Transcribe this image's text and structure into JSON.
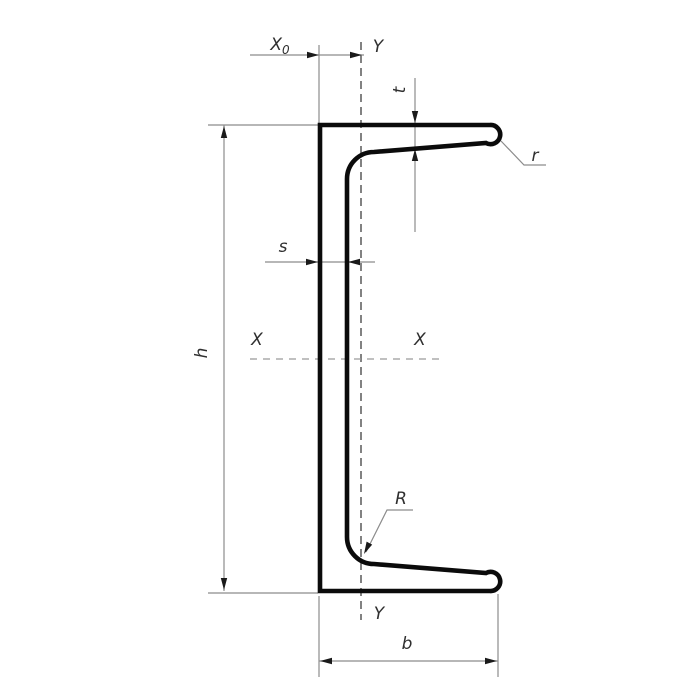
{
  "diagram": {
    "kind": "channel-cross-section-drawing",
    "labels": {
      "x0_main": "X",
      "x0_sub": "0",
      "y_top": "Y",
      "t": "t",
      "r": "r",
      "s": "s",
      "h": "h",
      "x_left": "X",
      "x_right": "X",
      "R": "R",
      "y_bottom": "Y",
      "b": "b"
    },
    "colors": {
      "background": "#ffffff",
      "profile_outline": "#0b0b0b",
      "thin_line": "#8c8c8c",
      "centerline_vertical": "#3f3f3f",
      "centerline_horizontal": "#9a9a9a",
      "label_text": "#2f2f2f"
    }
  }
}
